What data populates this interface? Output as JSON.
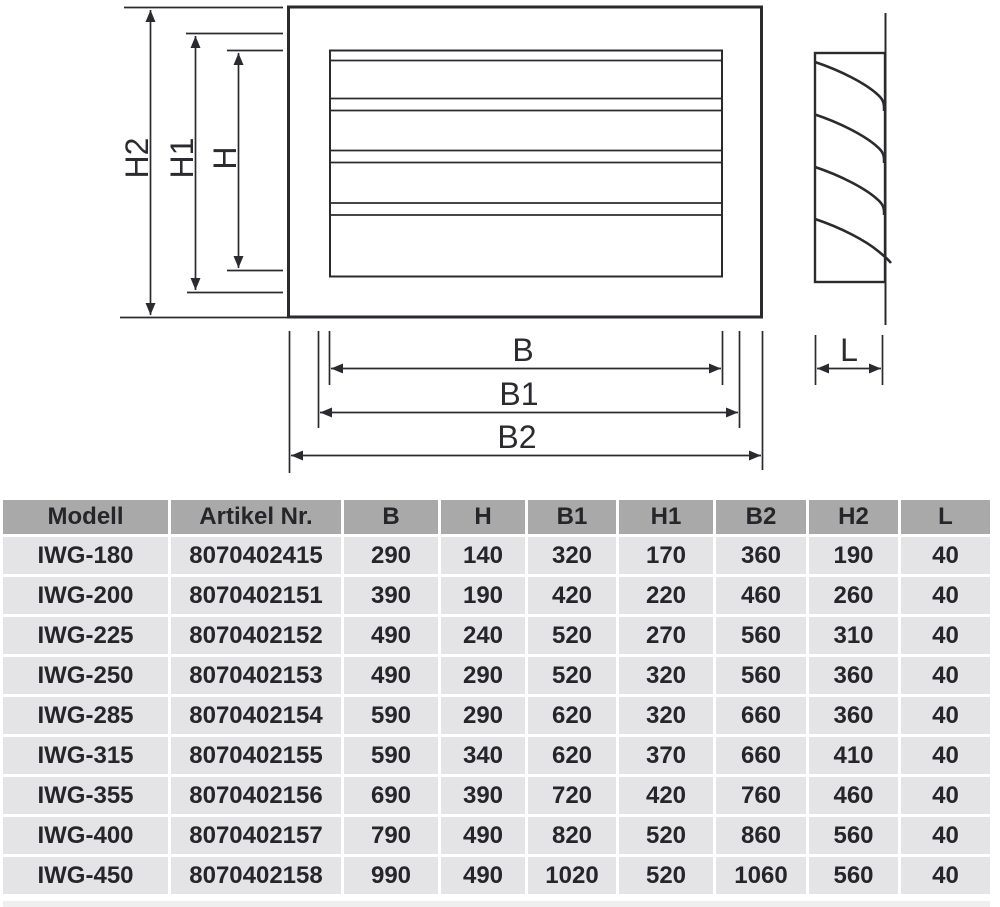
{
  "diagram": {
    "line_color": "#2b2b2f",
    "labels": {
      "h2": "H2",
      "h1": "H1",
      "h": "H",
      "b": "B",
      "b1": "B1",
      "b2": "B2",
      "l": "L"
    }
  },
  "table": {
    "header_bg": "#a9a9a9",
    "row_bg": "#e4e4e6",
    "text_color": "#26262a",
    "headers": [
      "Modell",
      "Artikel Nr.",
      "B",
      "H",
      "B1",
      "H1",
      "B2",
      "H2",
      "L"
    ],
    "rows": [
      [
        "IWG-180",
        "8070402415",
        "290",
        "140",
        "320",
        "170",
        "360",
        "190",
        "40"
      ],
      [
        "IWG-200",
        "8070402151",
        "390",
        "190",
        "420",
        "220",
        "460",
        "260",
        "40"
      ],
      [
        "IWG-225",
        "8070402152",
        "490",
        "240",
        "520",
        "270",
        "560",
        "310",
        "40"
      ],
      [
        "IWG-250",
        "8070402153",
        "490",
        "290",
        "520",
        "320",
        "560",
        "360",
        "40"
      ],
      [
        "IWG-285",
        "8070402154",
        "590",
        "290",
        "620",
        "320",
        "660",
        "360",
        "40"
      ],
      [
        "IWG-315",
        "8070402155",
        "590",
        "340",
        "620",
        "370",
        "660",
        "410",
        "40"
      ],
      [
        "IWG-355",
        "8070402156",
        "690",
        "390",
        "720",
        "420",
        "760",
        "460",
        "40"
      ],
      [
        "IWG-400",
        "8070402157",
        "790",
        "490",
        "820",
        "520",
        "860",
        "560",
        "40"
      ],
      [
        "IWG-450",
        "8070402158",
        "990",
        "490",
        "1020",
        "520",
        "1060",
        "560",
        "40"
      ]
    ]
  }
}
